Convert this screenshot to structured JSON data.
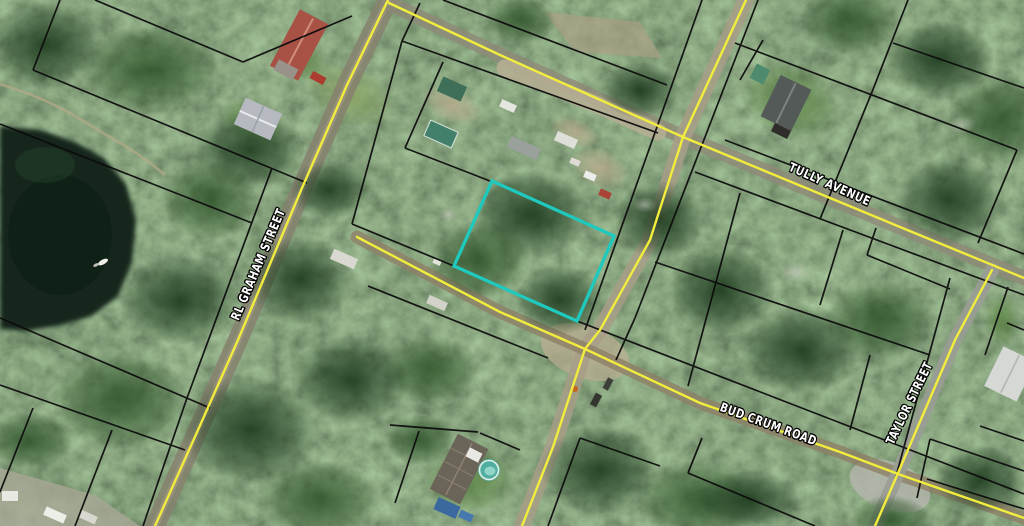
{
  "map": {
    "type": "aerial-parcel-map",
    "street_labels": [
      {
        "id": "rl-graham",
        "text": "RL GRAHAM STREET"
      },
      {
        "id": "tully",
        "text": "TULLY AVENUE"
      },
      {
        "id": "bud-crum",
        "text": "BUD CRUM ROAD"
      },
      {
        "id": "taylor",
        "text": "TAYLOR STREET"
      }
    ],
    "highlight": {
      "description": "selected parcel outline",
      "color": "#1fc9bd"
    },
    "overlay_colors": {
      "road_centerline": "#f2ec3d",
      "parcel_boundary": "#0b0b0b",
      "label_fill": "#ffffff",
      "label_outline": "#000000"
    }
  }
}
